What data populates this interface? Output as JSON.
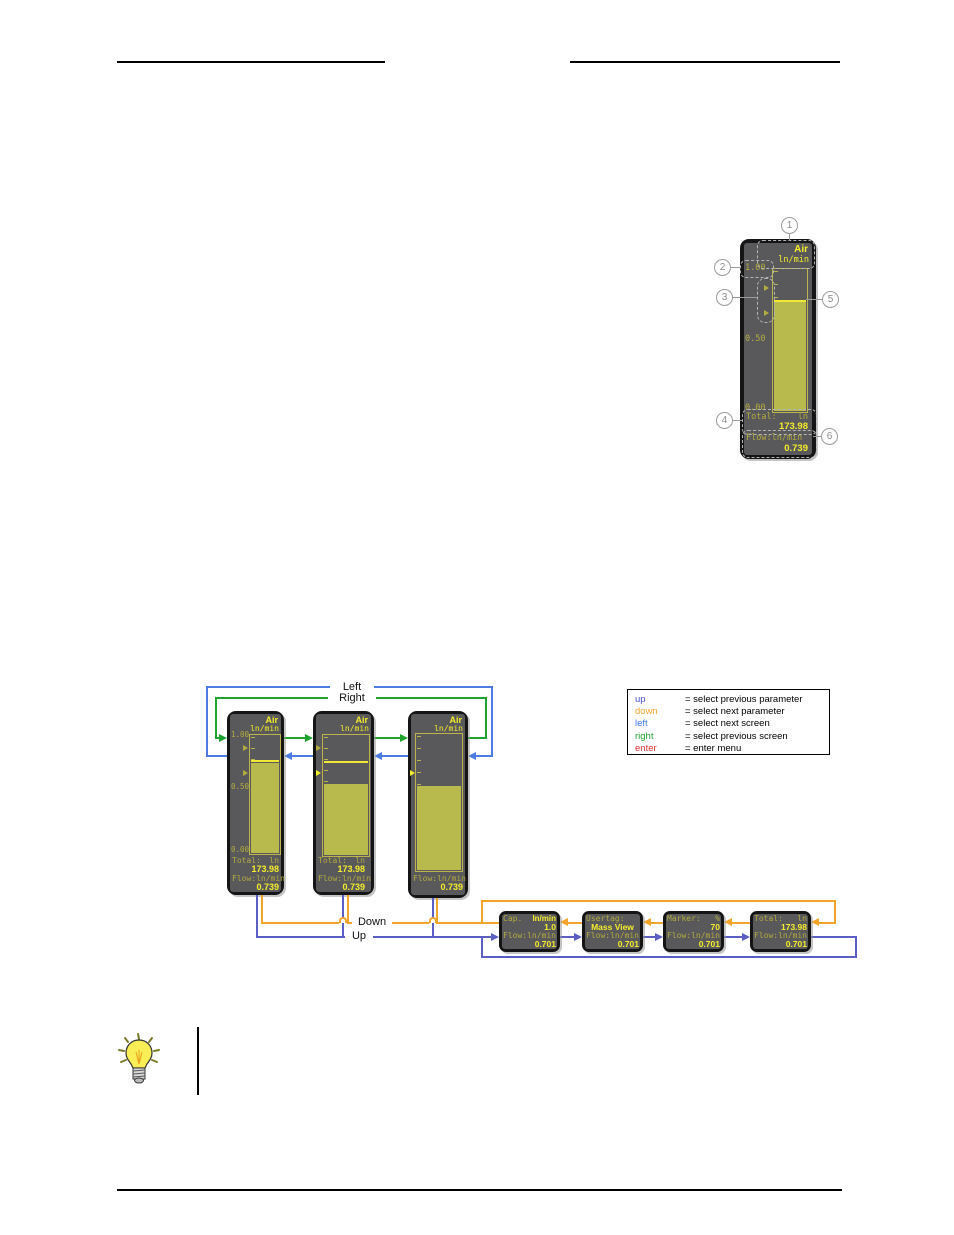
{
  "figure_callout": {
    "screen": {
      "gas": "Air",
      "unit": "ln/min",
      "scale_top": "1.00",
      "scale_mid": "0.50",
      "scale_bottom": "0.00",
      "total_label": "Total:",
      "total_unit": "ln",
      "total_value": "173.98",
      "flow_label": "Flow:ln/min",
      "flow_value": "0.739",
      "bar_fill_pct": 76,
      "marker_pct": 77
    },
    "callouts": [
      "1",
      "2",
      "3",
      "4",
      "5",
      "6"
    ]
  },
  "figure_nav": {
    "labels": {
      "left": "Left",
      "right": "Right",
      "down": "Down",
      "up": "Up"
    },
    "legend": [
      {
        "key": "up",
        "meaning": "= select previous parameter"
      },
      {
        "key": "down",
        "meaning": "= select next parameter"
      },
      {
        "key": "left",
        "meaning": "= select next screen"
      },
      {
        "key": "right",
        "meaning": "= select previous screen"
      },
      {
        "key": "enter",
        "meaning": "= enter menu"
      }
    ],
    "bar_screens": [
      {
        "gas": "Air",
        "unit": "ln/min",
        "scale_top": "1.00",
        "scale_mid": "0.50",
        "scale_bottom": "0.00",
        "total_label": "Total:",
        "total_unit": "ln",
        "total_value": "173.98",
        "flow_label": "Flow:ln/min",
        "flow_value": "0.739",
        "bar_fill_pct": 76,
        "marker_pct": 77
      },
      {
        "gas": "Air",
        "unit": "ln/min",
        "total_label": "Total:",
        "total_unit": "ln",
        "total_value": "173.98",
        "flow_label": "Flow:ln/min",
        "flow_value": "0.739",
        "bar_fill_pct": 59,
        "marker_pct": 77
      },
      {
        "gas": "Air",
        "unit": "ln/min",
        "flow_label": "Flow:ln/min",
        "flow_value": "0.739",
        "bar_fill_pct": 61
      }
    ],
    "param_screens": [
      {
        "label": "Cap.",
        "label_right": "ln/min",
        "value": "1.0",
        "flow_label": "Flow:ln/min",
        "flow_value": "0.701"
      },
      {
        "label": "Usertag:",
        "label_right": "",
        "value": "Mass View",
        "flow_label": "Flow:ln/min",
        "flow_value": "0.701"
      },
      {
        "label": "Marker:",
        "label_right": "%",
        "value": "70",
        "flow_label": "Flow:ln/min",
        "flow_value": "0.701"
      },
      {
        "label": "Total:",
        "label_right": "ln",
        "value": "173.98",
        "flow_label": "Flow:ln/min",
        "flow_value": "0.701"
      }
    ]
  },
  "colors": {
    "arrow_green": "#1ea32e",
    "arrow_blue": "#4d7ce0",
    "arrow_slate_blue": "#5b5fc4",
    "arrow_orange": "#f2a52a",
    "enter_red": "#e03030",
    "lcd_bright_yellow": "#f5ee2a",
    "lcd_olive": "#b4ab3e",
    "lcd_bar_fill": "#b9ba4e",
    "lcd_screen_bg": "#59595b"
  }
}
